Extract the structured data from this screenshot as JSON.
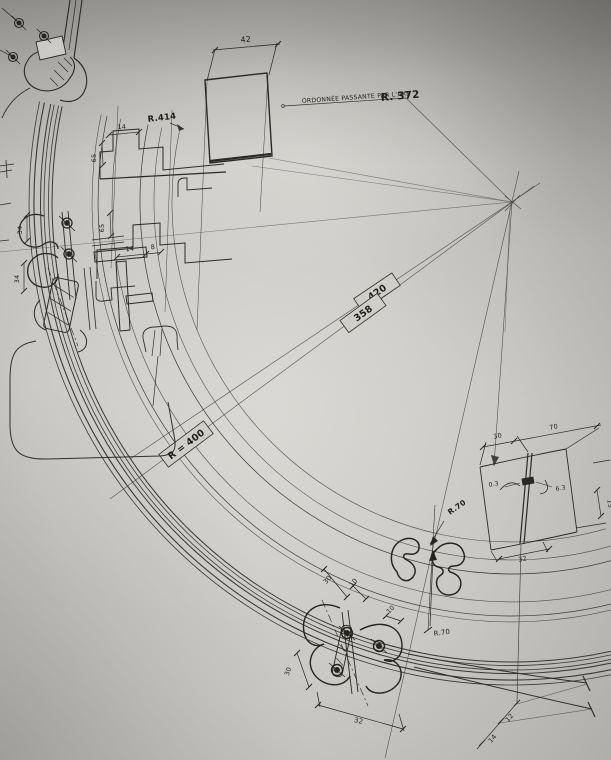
{
  "sheet": {
    "note": {
      "text": "ORDONNÉE  PASSANTE  PAR  L'AXE",
      "radius": "R. 372"
    },
    "labels": {
      "r414": "R.414",
      "box_420": "420",
      "box_358": "358",
      "box_r400": "R = 400",
      "r70_upper": "R.70",
      "r70_lower": "R.70"
    },
    "dimensions": {
      "d42": "42",
      "d14_top": "14",
      "d65_a": "65",
      "d65_b": "65",
      "d14_mid": "14",
      "d8": "8",
      "d34_a": "34",
      "d34_b": "34",
      "d30_profile": "30",
      "d10_a": "10",
      "d10_b": "10",
      "d30_joint": "30",
      "d32_joint": "32",
      "d30_panel": "30",
      "d70_panel": "70",
      "d15_edge": "15",
      "d03_gap": "0.3",
      "d63_gap": "6.3",
      "d32_panel": "32",
      "d12_spacing": "12",
      "d14_spacing": "14"
    }
  }
}
